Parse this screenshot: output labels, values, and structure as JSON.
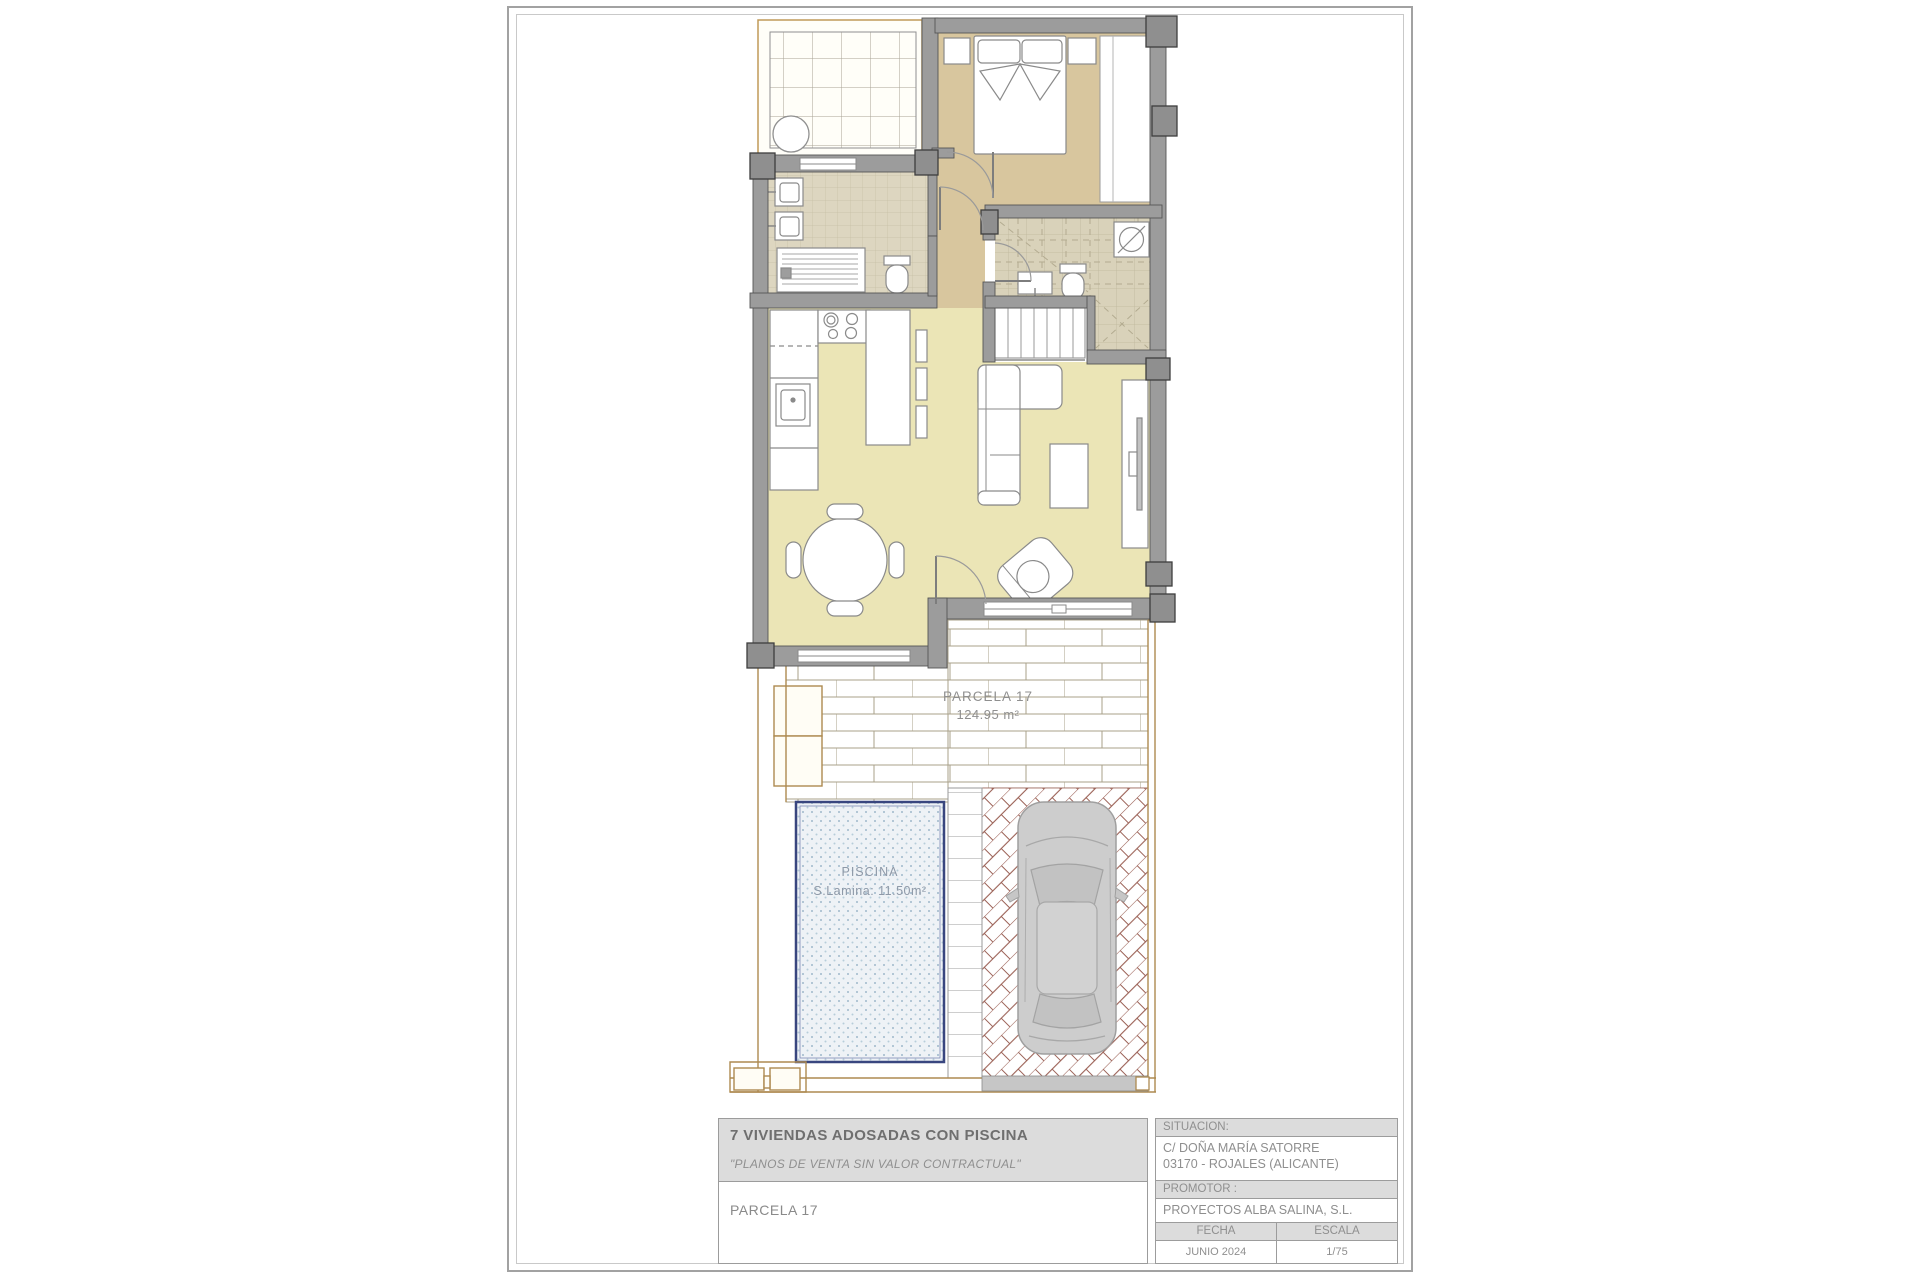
{
  "plan": {
    "parcela": {
      "name": "PARCELA 17",
      "area": "124.95 m²"
    },
    "pool": {
      "name": "PISCINA",
      "area_label": "S.Lamina: 11.50m²"
    }
  },
  "title_block": {
    "project_title": "7 VIVIENDAS ADOSADAS CON PISCINA",
    "disclaimer": "\"PLANOS DE VENTA SIN VALOR CONTRACTUAL\"",
    "sheet_name": "PARCELA 17",
    "situacion": {
      "label": "SITUACION:",
      "address_line1": "C/ DOÑA MARÍA SATORRE",
      "address_line2": "03170 - ROJALES (ALICANTE)"
    },
    "promotor": {
      "label": "PROMOTOR :",
      "name": "PROYECTOS ALBA SALINA, S.L."
    },
    "fecha": {
      "label": "FECHA",
      "value": "JUNIO 2024"
    },
    "escala": {
      "label": "ESCALA",
      "value": "1/75"
    }
  },
  "colors": {
    "wall": "#9c9c9c",
    "bedroom_floor": "#d8c69e",
    "living_floor": "#ebe5b6",
    "bathroom_tile": "#ddd6c0",
    "pool_border": "#39467f",
    "paving_line": "#9b6156",
    "plot_line": "#ad8a50",
    "text_gray": "#8e8e8e"
  }
}
